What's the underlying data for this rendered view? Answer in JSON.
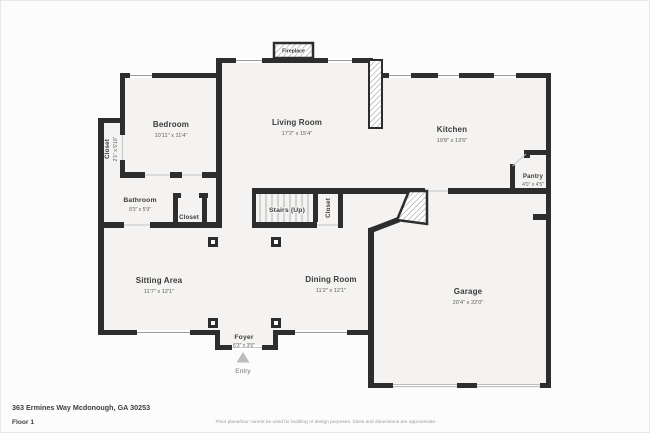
{
  "floorplan": {
    "rooms": [
      {
        "name": "Bedroom",
        "dims": "10'11\" x 11'4\""
      },
      {
        "name": "Living Room",
        "dims": "17'2\" x 15'4\""
      },
      {
        "name": "Kitchen",
        "dims": "19'8\" x 13'6\""
      },
      {
        "name": "Closet",
        "dims": "2'1\" x 5'10\""
      },
      {
        "name": "Bathroom",
        "dims": "8'3\" x 5'9\""
      },
      {
        "name": "Closet",
        "dims": ""
      },
      {
        "name": "Stairs (Up)",
        "dims": ""
      },
      {
        "name": "Closet",
        "dims": ""
      },
      {
        "name": "Pantry",
        "dims": "4'0\" x 4'5\""
      },
      {
        "name": "Sitting Area",
        "dims": "11'7\" x 12'1\""
      },
      {
        "name": "Dining Room",
        "dims": "11'2\" x 12'1\""
      },
      {
        "name": "Garage",
        "dims": "20'4\" x 22'0\""
      },
      {
        "name": "Foyer",
        "dims": "6'3\" x 3'5\""
      }
    ],
    "labels": {
      "fireplace": "Fireplace",
      "entry": "Entry"
    }
  },
  "footer": {
    "address": "363 Ermines Way Mcdonough, GA 30253",
    "floor": "Floor 1",
    "disclaimer": "Floor plans/tour cannot be used for building or design purposes. Sizes and dimensions are approximate."
  },
  "colors": {
    "wall": "#2d2d2d",
    "floor": "#f4f3f1",
    "background": "#fcfcfc",
    "label": "#3c3c3c",
    "dims": "#5f5f5f",
    "muted": "#9c9c9c",
    "entry_arrow": "#bdbdbd"
  }
}
